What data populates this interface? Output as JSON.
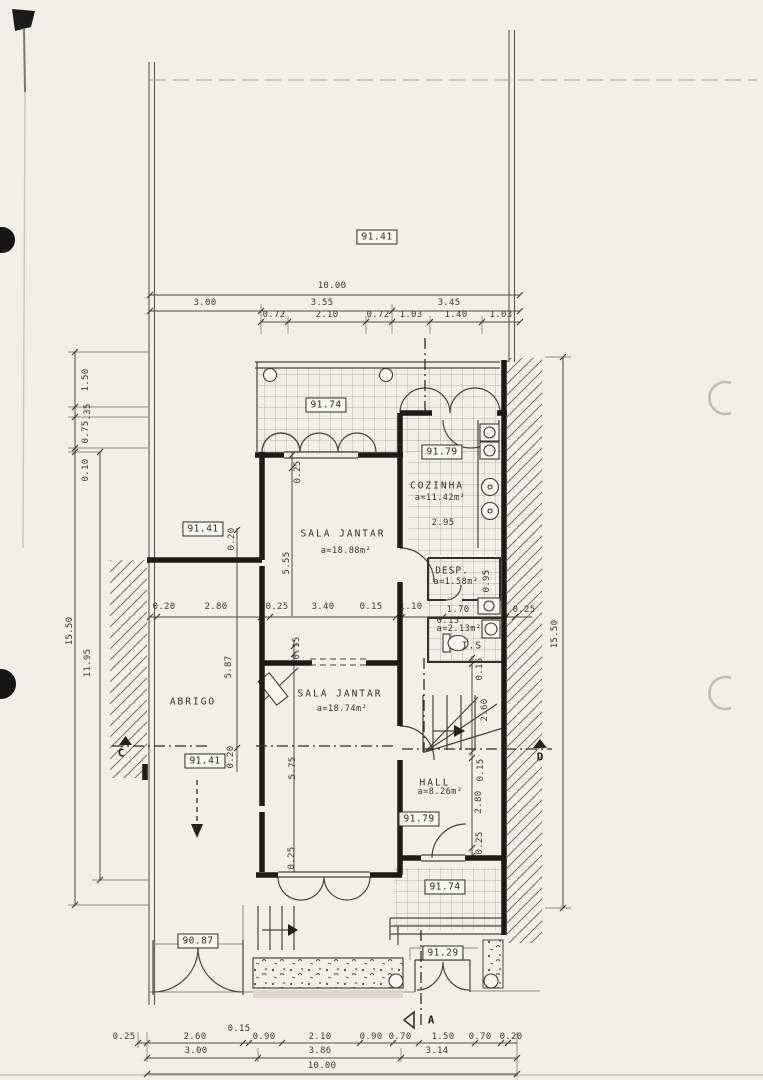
{
  "document": {
    "type": "scanned floor plan",
    "sheet": "ground floor / site plan"
  },
  "elevations": {
    "site": "91.41",
    "terrace_upper": "91.74",
    "kitchen": "91.79",
    "left_upper": "91.41",
    "left_lower": "91.41",
    "hall": "91.79",
    "terrace_lower": "91.74",
    "driveway": "90.87",
    "entrance": "91.29"
  },
  "rooms": {
    "cozinha": {
      "name": "COZINHA",
      "area": "a=11.42m²"
    },
    "sala_upper": {
      "name": "SALA JANTAR",
      "area": "a=18.88m²"
    },
    "sala_lower": {
      "name": "SALA JANTAR",
      "area": "a=18.74m²"
    },
    "abrigo": {
      "name": "ABRIGO"
    },
    "hall": {
      "name": "HALL",
      "area": "a=8.26m²"
    },
    "desp": {
      "name": "DESP.",
      "area": "a=1.58m²"
    },
    "is": {
      "name": "I.S",
      "area": "a=2.13m²"
    }
  },
  "sections": {
    "c": "C",
    "d": "D",
    "a": "A"
  },
  "dim_labels": [
    {
      "t": "10.00",
      "x": 332,
      "y": 286
    },
    {
      "t": "3.00",
      "x": 205,
      "y": 303
    },
    {
      "t": "3.55",
      "x": 322,
      "y": 303
    },
    {
      "t": "3.45",
      "x": 449,
      "y": 303
    },
    {
      "t": "0.72",
      "x": 274,
      "y": 315
    },
    {
      "t": "2.10",
      "x": 327,
      "y": 315
    },
    {
      "t": "0.72",
      "x": 378,
      "y": 315
    },
    {
      "t": "1.03",
      "x": 411,
      "y": 315
    },
    {
      "t": "1.40",
      "x": 456,
      "y": 315
    },
    {
      "t": "1.03",
      "x": 501,
      "y": 315
    },
    {
      "t": "1.50",
      "x": 86,
      "y": 380,
      "v": 1
    },
    {
      "t": ".35",
      "x": 88,
      "y": 412,
      "v": 1
    },
    {
      "t": "0.75",
      "x": 86,
      "y": 432,
      "v": 1
    },
    {
      "t": "0.10",
      "x": 86,
      "y": 470,
      "v": 1
    },
    {
      "t": "15.50",
      "x": 70,
      "y": 631,
      "v": 1
    },
    {
      "t": "11.95",
      "x": 88,
      "y": 663,
      "v": 1
    },
    {
      "t": "15.50",
      "x": 555,
      "y": 634,
      "v": 1
    },
    {
      "t": "0.20",
      "x": 164,
      "y": 607
    },
    {
      "t": "2.80",
      "x": 216,
      "y": 607
    },
    {
      "t": "0.25",
      "x": 277,
      "y": 607
    },
    {
      "t": "3.40",
      "x": 323,
      "y": 607
    },
    {
      "t": "0.15",
      "x": 371,
      "y": 607
    },
    {
      "t": "1.10",
      "x": 411,
      "y": 607
    },
    {
      "t": "1.70",
      "x": 458,
      "y": 610
    },
    {
      "t": "0.25",
      "x": 524,
      "y": 610
    },
    {
      "t": "0.25",
      "x": 298,
      "y": 472,
      "v": 1
    },
    {
      "t": "5.55",
      "x": 287,
      "y": 563,
      "v": 1
    },
    {
      "t": "0.20",
      "x": 232,
      "y": 539,
      "v": 1
    },
    {
      "t": "5.87",
      "x": 229,
      "y": 667,
      "v": 1
    },
    {
      "t": "0.20",
      "x": 231,
      "y": 757,
      "v": 1
    },
    {
      "t": "0.15",
      "x": 297,
      "y": 648,
      "v": 1
    },
    {
      "t": "5.75",
      "x": 293,
      "y": 768,
      "v": 1
    },
    {
      "t": "0.25",
      "x": 292,
      "y": 858,
      "v": 1
    },
    {
      "t": "2.95",
      "x": 443,
      "y": 523
    },
    {
      "t": "0.95",
      "x": 487,
      "y": 581,
      "v": 1
    },
    {
      "t": "0.15",
      "x": 448,
      "y": 621
    },
    {
      "t": "0.15",
      "x": 480,
      "y": 669,
      "v": 1
    },
    {
      "t": "2.60",
      "x": 485,
      "y": 710,
      "v": 1
    },
    {
      "t": "0.15",
      "x": 481,
      "y": 770,
      "v": 1
    },
    {
      "t": "2.80",
      "x": 479,
      "y": 802,
      "v": 1
    },
    {
      "t": "0.25",
      "x": 480,
      "y": 843,
      "v": 1
    },
    {
      "t": "0.25",
      "x": 124,
      "y": 1037
    },
    {
      "t": "2.60",
      "x": 195,
      "y": 1037
    },
    {
      "t": "0.15",
      "x": 239,
      "y": 1029
    },
    {
      "t": "0.90",
      "x": 264,
      "y": 1037
    },
    {
      "t": "2.10",
      "x": 320,
      "y": 1037
    },
    {
      "t": "0.90",
      "x": 371,
      "y": 1037
    },
    {
      "t": "0.70",
      "x": 400,
      "y": 1037
    },
    {
      "t": "1.50",
      "x": 443,
      "y": 1037
    },
    {
      "t": "0.70",
      "x": 480,
      "y": 1037
    },
    {
      "t": "0.20",
      "x": 511,
      "y": 1037
    },
    {
      "t": "3.00",
      "x": 196,
      "y": 1051
    },
    {
      "t": "3.86",
      "x": 320,
      "y": 1051
    },
    {
      "t": "3.14",
      "x": 437,
      "y": 1051
    },
    {
      "t": "10.00",
      "x": 322,
      "y": 1066
    }
  ]
}
